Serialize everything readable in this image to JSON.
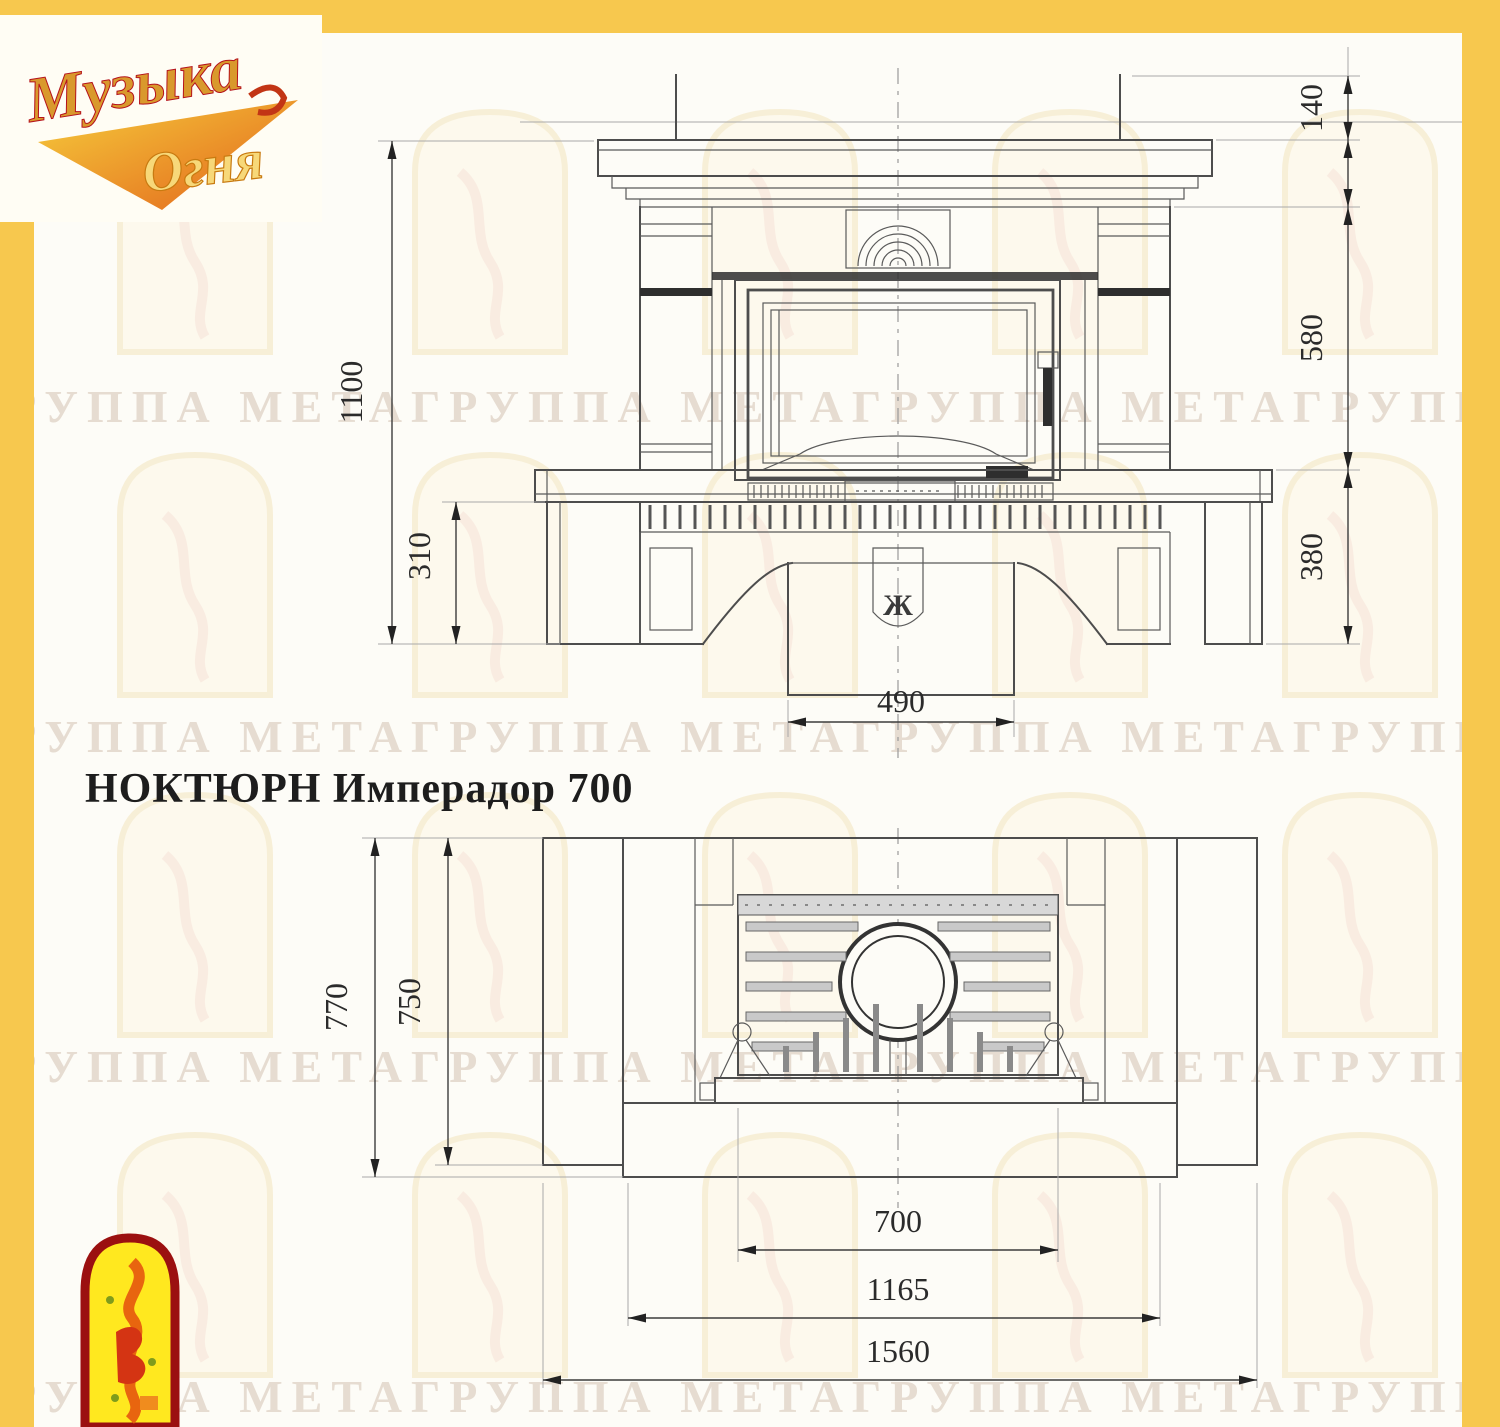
{
  "page": {
    "background": "#fdfcf7",
    "frame_color": "#f7c84e"
  },
  "logo": {
    "word1": "Музыка",
    "word2": "Огня",
    "gold": "#d9992c",
    "orange": "#e2621b",
    "red": "#b5121b"
  },
  "title": "НОКТЮРН Имперадор 700",
  "watermark": {
    "text": "ГРУППА МЕТАГРУППА МЕТАГРУППА МЕТАГРУППА МЕТАГРУППА МЕТА",
    "color": "#e6dcd1"
  },
  "front_view": {
    "view_name": "front elevation",
    "dims": {
      "flue_stub_height": "140",
      "firebox_zone_height": "580",
      "base_height": "380",
      "overall_height": "1100",
      "bench_zone_height": "310",
      "pedestal_width": "490"
    },
    "keystone_glyph": "Ж"
  },
  "plan_view": {
    "view_name": "plan",
    "dims": {
      "overall_depth": "770",
      "side_depth": "750",
      "insert_width": "700",
      "body_width": "1165",
      "overall_width": "1560"
    }
  },
  "emblem": {
    "border": "#9b1010",
    "fill": "#ffe81f",
    "flame": "#e8650f",
    "accent_red": "#d43413"
  },
  "drawing_colors": {
    "line": "#4d4d4d",
    "dim": "#3c3c3c",
    "extension": "#a9a9a9",
    "watermark": "#e6dcd1"
  }
}
